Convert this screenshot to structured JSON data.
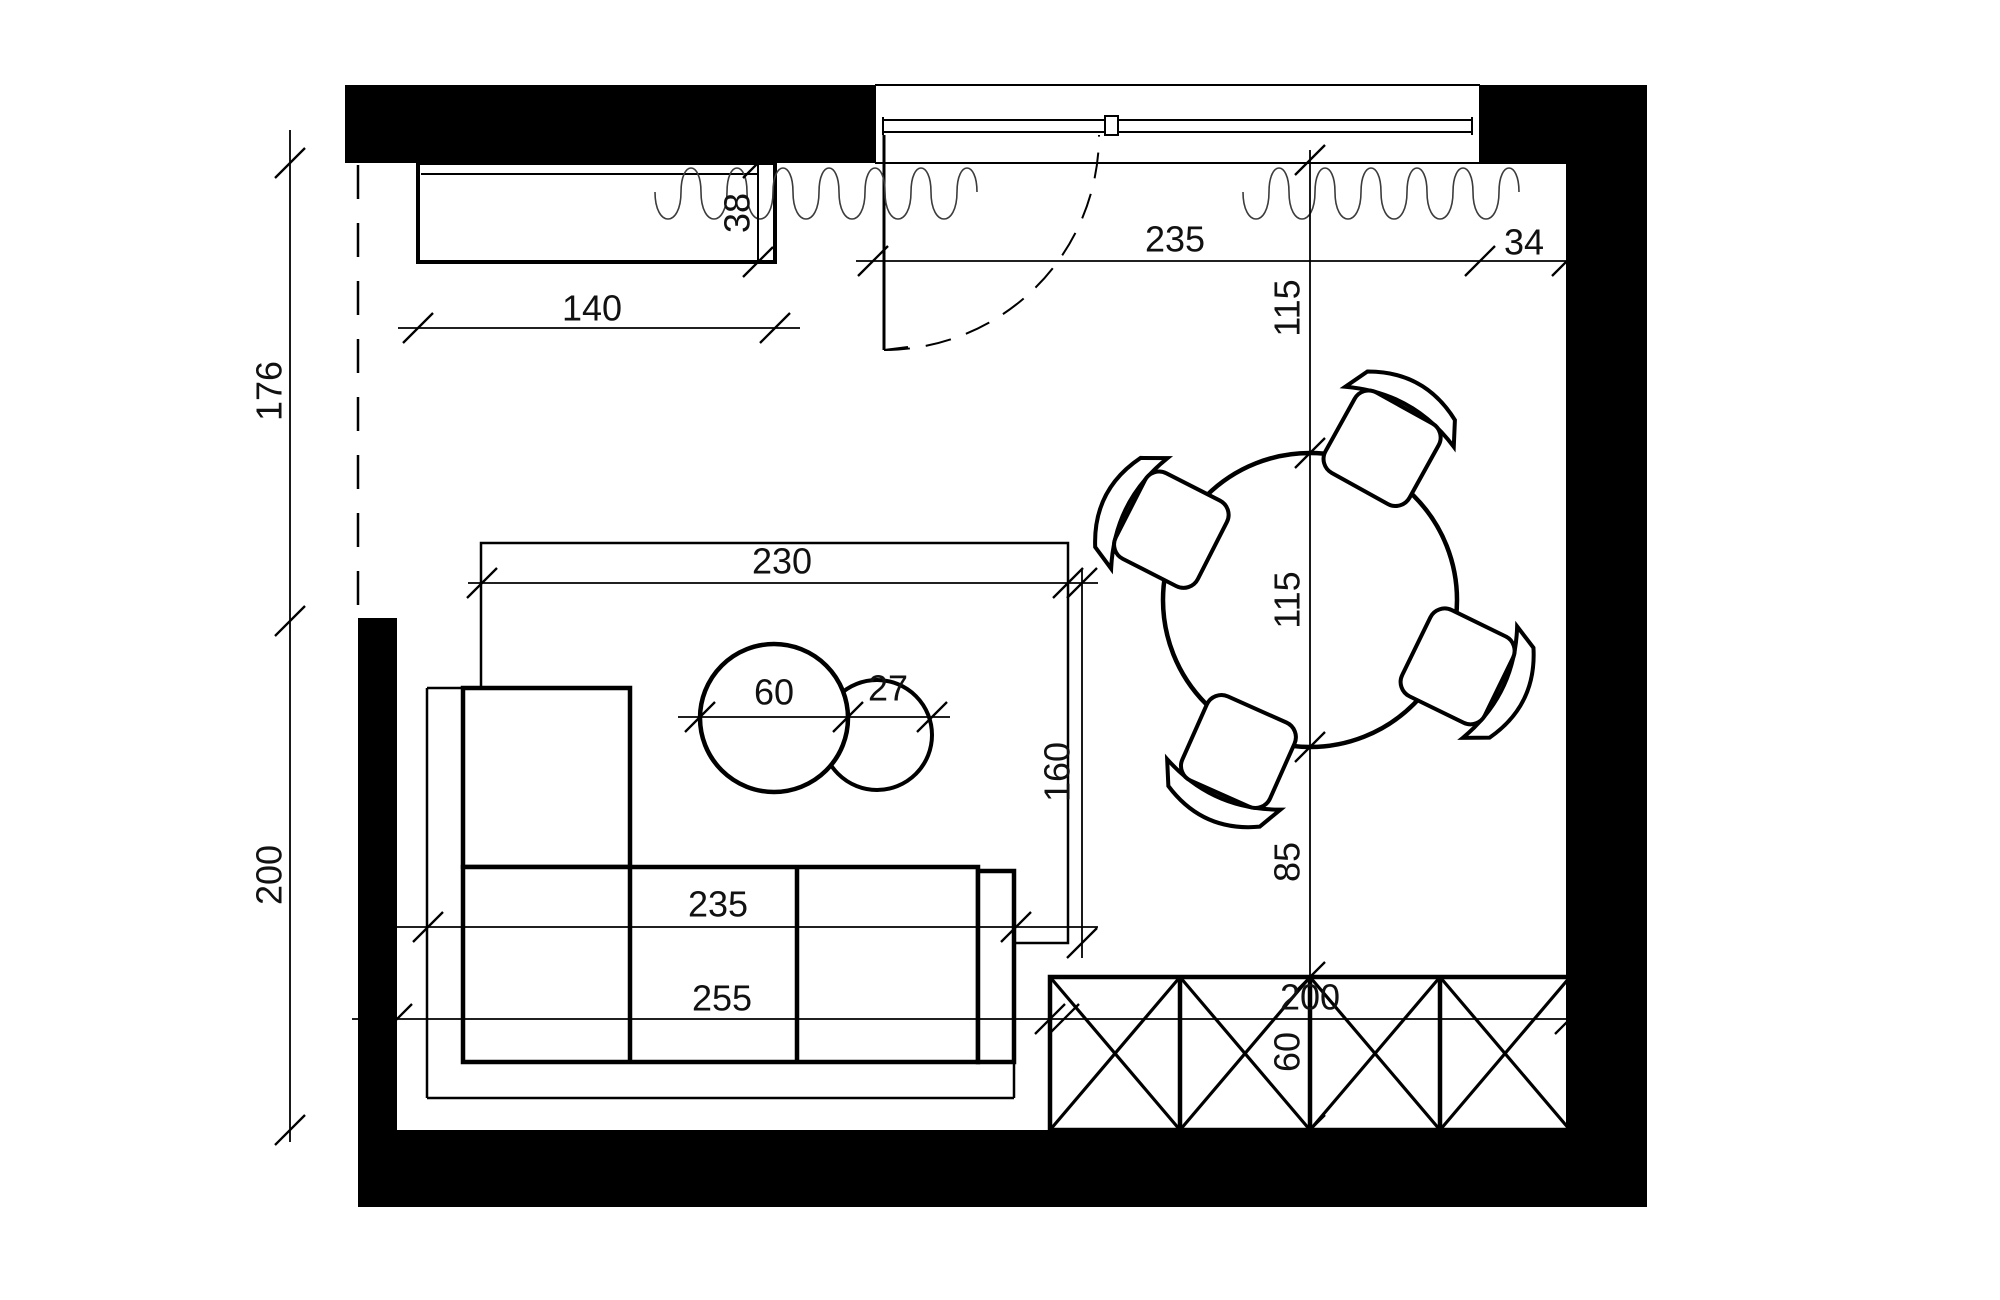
{
  "meta": {
    "title": "apartment-living-room-floor-plan",
    "canvas_w": 2000,
    "canvas_h": 1300,
    "colors": {
      "ink": "#000000",
      "dim": "#1a1a1a",
      "curtain": "#3c3c3c",
      "bg": "#ffffff"
    }
  },
  "walls": [
    {
      "name": "wall-top-left",
      "x": 345,
      "y": 85,
      "w": 530,
      "h": 78
    },
    {
      "name": "wall-top-right",
      "x": 1480,
      "y": 85,
      "w": 167,
      "h": 78
    },
    {
      "name": "wall-right",
      "x": 1566,
      "y": 163,
      "w": 81,
      "h": 1044
    },
    {
      "name": "wall-bottom",
      "x": 358,
      "y": 1130,
      "w": 1289,
      "h": 77
    },
    {
      "name": "wall-left-lower",
      "x": 358,
      "y": 618,
      "w": 39,
      "h": 512
    }
  ],
  "dashed_wall": {
    "x": 358,
    "y1": 165,
    "y2": 616,
    "dash": "34 24"
  },
  "window": {
    "lines": [
      {
        "x1": 875,
        "y1": 85,
        "x2": 1480,
        "y2": 85,
        "w": 2
      },
      {
        "x1": 883,
        "y1": 120,
        "x2": 1472,
        "y2": 120,
        "w": 2
      },
      {
        "x1": 883,
        "y1": 132,
        "x2": 1472,
        "y2": 132,
        "w": 2
      },
      {
        "x1": 875,
        "y1": 163,
        "x2": 1566,
        "y2": 163,
        "w": 2
      },
      {
        "x1": 875,
        "y1": 85,
        "x2": 875,
        "y2": 163,
        "w": 2
      },
      {
        "x1": 1480,
        "y1": 85,
        "x2": 1480,
        "y2": 163,
        "w": 2
      },
      {
        "x1": 883,
        "y1": 117,
        "x2": 883,
        "y2": 135,
        "w": 2
      },
      {
        "x1": 1472,
        "y1": 117,
        "x2": 1472,
        "y2": 135,
        "w": 2
      }
    ],
    "mullion": {
      "x": 1105,
      "y": 116,
      "w": 13,
      "h": 19
    }
  },
  "door": {
    "leaf": {
      "x1": 884,
      "y1": 135,
      "x2": 884,
      "y2": 350,
      "w": 3
    },
    "foot": {
      "x1": 884,
      "y1": 350,
      "x2": 908,
      "y2": 347,
      "w": 2
    },
    "arc": {
      "sx": 884,
      "sy": 350,
      "ex": 1099,
      "ey": 135,
      "r": 215,
      "dash": "26 16",
      "w": 2
    }
  },
  "curtain": {
    "y_mid": 192,
    "y_bot": 228,
    "y_top": 160,
    "period": 46,
    "segments": [
      [
        655,
        1008
      ],
      [
        1243,
        1563
      ]
    ]
  },
  "cabinet": {
    "rect": {
      "x": 418,
      "y": 163,
      "w": 357,
      "h": 99,
      "sw": 4
    },
    "inner_h": {
      "x1": 421,
      "y1": 174,
      "x2": 758,
      "y2": 174,
      "w": 2
    },
    "inner_v": {
      "x1": 758,
      "y1": 163,
      "x2": 758,
      "y2": 262,
      "w": 2
    }
  },
  "rug": {
    "x": 481,
    "y": 543,
    "w": 587,
    "h": 400,
    "sw": 2.5
  },
  "sofa": {
    "bg": {
      "x": 427,
      "y": 688,
      "w": 587,
      "h": 410
    },
    "thin": [
      {
        "x1": 427,
        "y1": 688,
        "x2": 630,
        "y2": 688
      },
      {
        "x1": 427,
        "y1": 688,
        "x2": 427,
        "y2": 1098
      },
      {
        "x1": 427,
        "y1": 1098,
        "x2": 1014,
        "y2": 1098
      },
      {
        "x1": 1014,
        "y1": 1098,
        "x2": 1014,
        "y2": 871
      },
      {
        "x1": 1014,
        "y1": 871,
        "x2": 978,
        "y2": 871
      }
    ],
    "bold_rects": [
      {
        "x": 463,
        "y": 688,
        "w": 167,
        "h": 179
      },
      {
        "x": 463,
        "y": 867,
        "w": 515,
        "h": 195
      },
      {
        "x": 978,
        "y": 871,
        "w": 36,
        "h": 191
      }
    ],
    "dividers": [
      {
        "x1": 630,
        "y1": 867,
        "x2": 630,
        "y2": 1062
      },
      {
        "x1": 797,
        "y1": 867,
        "x2": 797,
        "y2": 1062
      }
    ],
    "sw_thin": 2.5,
    "sw_bold": 4.5
  },
  "coffee_tables": [
    {
      "name": "coffee-table-small",
      "cx": 877,
      "cy": 735,
      "r": 55,
      "sw": 4
    },
    {
      "name": "coffee-table-large",
      "cx": 774,
      "cy": 718,
      "r": 74,
      "sw": 4.5
    }
  ],
  "dining_table": {
    "cx": 1310,
    "cy": 600,
    "r": 147,
    "sw": 4.5
  },
  "chairs": [
    {
      "name": "chair-north-east",
      "cx": 1385,
      "cy": 443,
      "rot": 29
    },
    {
      "name": "chair-west",
      "cx": 1166,
      "cy": 527,
      "rot": -63
    },
    {
      "name": "chair-south-west",
      "cx": 1236,
      "cy": 757,
      "rot": -156
    },
    {
      "name": "chair-south-east",
      "cx": 1463,
      "cy": 669,
      "rot": 116
    }
  ],
  "chair_shape": {
    "seat": {
      "x": -48,
      "y": -40,
      "w": 96,
      "h": 92,
      "rx": 16,
      "sw": 4
    },
    "back": "M -62 -30 Q 0 -58 62 -30 L 50 -54 Q 0 -82 -50 -54 Z"
  },
  "sideboard": {
    "x": 1050,
    "y": 977,
    "w": 520,
    "h": 153,
    "cells": 4,
    "sw": 4.5,
    "sw_x": 3.2
  },
  "dimensions": {
    "lines": [
      {
        "x1": 290,
        "y1": 130,
        "x2": 290,
        "y2": 1142
      },
      {
        "x1": 398,
        "y1": 328,
        "x2": 800,
        "y2": 328
      },
      {
        "x1": 758,
        "y1": 163,
        "x2": 758,
        "y2": 262
      },
      {
        "x1": 856,
        "y1": 261,
        "x2": 1580,
        "y2": 261
      },
      {
        "x1": 1310,
        "y1": 150,
        "x2": 1310,
        "y2": 1145
      },
      {
        "x1": 468,
        "y1": 583,
        "x2": 1098,
        "y2": 583
      },
      {
        "x1": 1082,
        "y1": 570,
        "x2": 1082,
        "y2": 958
      },
      {
        "x1": 385,
        "y1": 927,
        "x2": 1098,
        "y2": 927
      },
      {
        "x1": 352,
        "y1": 1019,
        "x2": 1590,
        "y2": 1019
      },
      {
        "x1": 678,
        "y1": 717,
        "x2": 950,
        "y2": 717
      }
    ],
    "ticks": [
      [
        290,
        163
      ],
      [
        290,
        621
      ],
      [
        290,
        1130
      ],
      [
        418,
        328
      ],
      [
        775,
        328
      ],
      [
        758,
        163
      ],
      [
        758,
        262
      ],
      [
        873,
        261
      ],
      [
        1480,
        261
      ],
      [
        1567,
        261
      ],
      [
        1310,
        160
      ],
      [
        1310,
        453
      ],
      [
        1310,
        747
      ],
      [
        1310,
        977
      ],
      [
        1310,
        1130
      ],
      [
        482,
        583
      ],
      [
        1068,
        583
      ],
      [
        1082,
        583
      ],
      [
        1082,
        943
      ],
      [
        428,
        927
      ],
      [
        1016,
        927
      ],
      [
        397,
        1019
      ],
      [
        1050,
        1019
      ],
      [
        1064,
        1019
      ],
      [
        1570,
        1019
      ],
      [
        700,
        717
      ],
      [
        848,
        717
      ],
      [
        932,
        717
      ]
    ],
    "labels": [
      {
        "text": "176",
        "x": 272,
        "y": 391,
        "rot": -90
      },
      {
        "text": "200",
        "x": 272,
        "y": 875,
        "rot": -90
      },
      {
        "text": "140",
        "x": 592,
        "y": 311,
        "rot": 0
      },
      {
        "text": "38",
        "x": 740,
        "y": 213,
        "rot": -90
      },
      {
        "text": "235",
        "x": 1175,
        "y": 242,
        "rot": 0
      },
      {
        "text": "34",
        "x": 1524,
        "y": 245,
        "rot": 0
      },
      {
        "text": "115",
        "x": 1290,
        "y": 308,
        "rot": -90
      },
      {
        "text": "115",
        "x": 1290,
        "y": 600,
        "rot": -90
      },
      {
        "text": "85",
        "x": 1290,
        "y": 862,
        "rot": -90
      },
      {
        "text": "60",
        "x": 1290,
        "y": 1052,
        "rot": -90
      },
      {
        "text": "200",
        "x": 1310,
        "y": 1000,
        "rot": 0
      },
      {
        "text": "230",
        "x": 782,
        "y": 564,
        "rot": 0
      },
      {
        "text": "160",
        "x": 1060,
        "y": 772,
        "rot": -90
      },
      {
        "text": "60",
        "x": 774,
        "y": 695,
        "rot": 0
      },
      {
        "text": "27",
        "x": 888,
        "y": 691,
        "rot": 0
      },
      {
        "text": "235",
        "x": 718,
        "y": 907,
        "rot": 0
      },
      {
        "text": "255",
        "x": 722,
        "y": 1001,
        "rot": 0
      }
    ],
    "font_size": 36,
    "tick_len": 15,
    "sw": 1.8
  }
}
